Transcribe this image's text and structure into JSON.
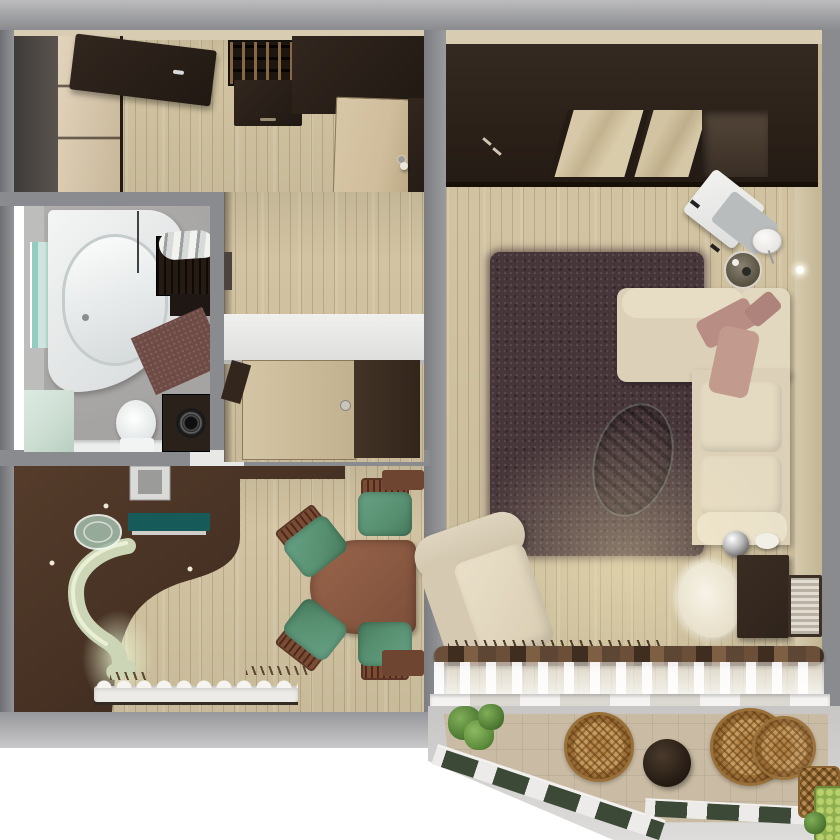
{
  "scene": {
    "type": "3d-floor-plan-top-view",
    "description": "photorealistic top-down render of a one-bedroom apartment with balcony",
    "text_content": "none (image contains no rendered text)"
  },
  "colors": {
    "wall-grey": "#8a8b8e",
    "wall-dark": "#6e6f72",
    "cream-trim": "#d8ccb2",
    "cream-wall": "#d6caae",
    "floor-light": "#d2c4a2",
    "floor-dark": "#4a3527",
    "dark-furniture": "#32271f",
    "darker-furniture": "#201812",
    "beige-wardrobe": "#d9c6a6",
    "door-light": "#cfbd9c",
    "grey-room": "#a5a4a2",
    "grey-wall-in": "#bdbdbb",
    "white-fixture": "#eef0f0",
    "teal-art": "#cfe4de",
    "teal-art2": "#93ccc0",
    "mat": "#6e4b45",
    "mint": "#cfdfd4",
    "sage": "#ccd6b6",
    "sage-light": "#e9f0d6",
    "teal": "#175a5a",
    "glass": "#9fb7a6",
    "table-wood": "#8b5a42",
    "chair-green": "#579070",
    "chair-wood": "#7c4b33",
    "rug": "#463539",
    "ottoman": "#4b584e",
    "sofa": "#dcd1b8",
    "sofa-light": "#e7ddc5",
    "throw": "#b88e84",
    "throw2": "#c29a8e",
    "pouf": "#f1ebdc",
    "chrome": "#cccccc",
    "stand": "#2f241c",
    "curtain": "#5d4634",
    "sill": "#dbd8d2",
    "tile": "#cabca4",
    "glaze": "#ecebe9",
    "pane": "#3d4937",
    "wicker": "#c79a5d",
    "plant": "#4e7a33",
    "crate": "#8fae4f",
    "glow": "#e9f2cf"
  },
  "rooms": {
    "hallway": {
      "label": "hallway",
      "items": [
        "entrance-door",
        "sliding-wardrobe",
        "shoe-rack",
        "hall-bench",
        "hall-wardrobe",
        "open-door",
        "vase"
      ]
    },
    "bathroom": {
      "label": "bathroom",
      "items": [
        "corner-bathtub",
        "glass-screen",
        "wall-art",
        "towel-basket",
        "bath-shelf",
        "bath-mat",
        "toilet",
        "washing-machine",
        "sink-counter"
      ]
    },
    "corridor": {
      "label": "corridor",
      "items": [
        "white-partition",
        "kitchen-door-light",
        "kitchen-door-dark",
        "door-handle",
        "bathroom-door"
      ]
    },
    "kitchen": {
      "label": "kitchen",
      "items": [
        "dark-wood-floor",
        "curved-bar-counter",
        "teal-countertop",
        "glass-bar-table",
        "vent-column",
        "dining-table",
        "dining-chair",
        "dining-chair",
        "dining-chair",
        "dining-chair",
        "wall-cabinet",
        "wall-cabinet",
        "window-sill",
        "radiator"
      ]
    },
    "living_room": {
      "label": "living room",
      "items": [
        "wardrobe",
        "mirror-doors",
        "wardrobe-niche",
        "shaggy-rug",
        "corner-sofa",
        "throw-blankets",
        "ottoman",
        "armchair",
        "fur-pouf",
        "desk-chair",
        "floor-lamp",
        "side-table",
        "tv-stand",
        "tv-frame",
        "chrome-sphere",
        "white-vase",
        "curtain-rod",
        "sheer-curtain",
        "window-sill",
        "radiator"
      ]
    },
    "balcony": {
      "label": "balcony",
      "items": [
        "wicker-chair",
        "wicker-chair",
        "round-table",
        "plants",
        "wicker-basket",
        "green-planter",
        "angled-glazing"
      ]
    }
  }
}
